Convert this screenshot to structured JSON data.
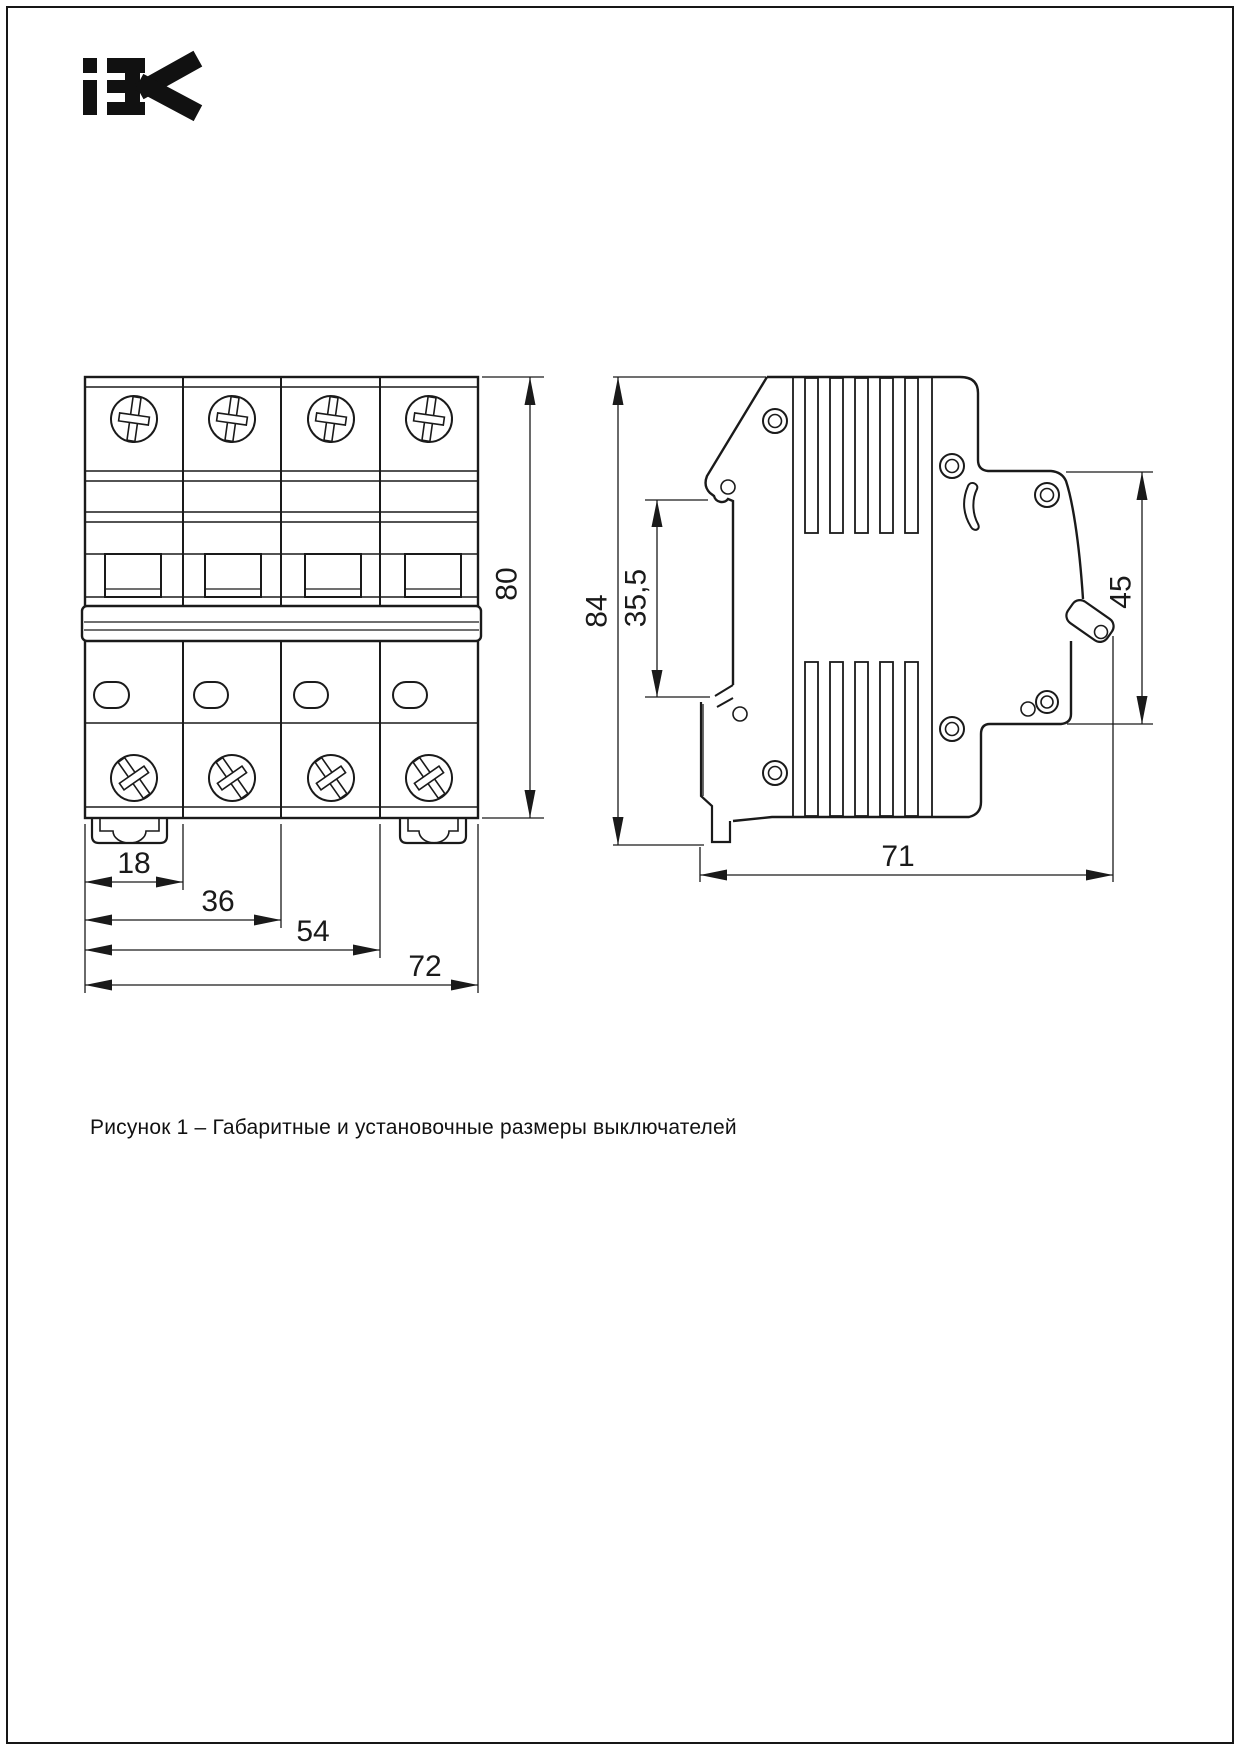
{
  "logo": {
    "brand": "IEK"
  },
  "figure": {
    "front_view": {
      "dims": {
        "height": "80",
        "module_width": "18",
        "width_2p": "36",
        "width_3p": "54",
        "width_4p": "72"
      }
    },
    "side_view": {
      "dims": {
        "height": "84",
        "rail_offset": "35,5",
        "front_face_height": "45",
        "depth": "71"
      }
    }
  },
  "caption": "Рисунок 1 – Габаритные и установочные размеры выключателей",
  "colors": {
    "line": "#1a1a1a",
    "background": "#ffffff"
  }
}
